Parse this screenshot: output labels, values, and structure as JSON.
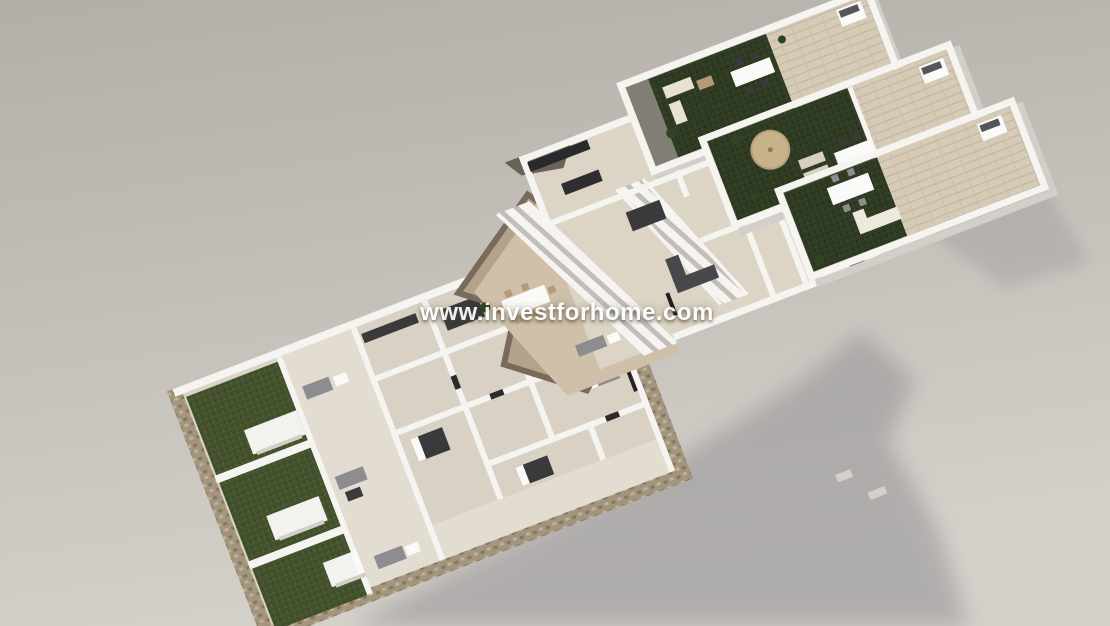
{
  "scene": {
    "description": "Aerial 3D render of an apartment development shown as three exploded levels: roof solarium terraces with lawns and barbecues (top right), upper floor with external staircases and terraces (middle), and ground-floor apartments with private gardens inside stone walls (bottom left)",
    "sections": [
      {
        "name": "roof-terrace-level"
      },
      {
        "name": "upper-floor-level"
      },
      {
        "name": "ground-floor-level"
      }
    ]
  },
  "watermark": {
    "text": "www.investforhome.com"
  },
  "palette": {
    "bg_top": "#b3aea8",
    "bg_bottom": "#d4d0ca",
    "shadow": "#8e8d91",
    "wall": "#f5f4f1",
    "wall_shade": "#d2cfc9",
    "wall_edge": "#bbb6af",
    "floor_beige": "#dbd4c6",
    "floor_light": "#e3ddd1",
    "floor_tan": "#cfc1a9",
    "deck": "#d6cbb6",
    "deck_line": "#c7bba4",
    "grass_roof": "#2f3b23",
    "grass_roof_dot": "#27321d",
    "grass_garden": "#44532e",
    "grass_garden_dot": "#394826",
    "stone": "#a3957d",
    "stone_dark": "#85775f",
    "stone_light": "#bfb197",
    "rock": "#796b5b",
    "rock_light": "#b2a38a",
    "dark_furniture": "#3a3a3c",
    "gray_furniture": "#8d8c90",
    "white_furniture": "#fafaf8",
    "wood": "#b59a77",
    "umbrella": "#c8b28c",
    "plant": "#2f4522",
    "roof_dark": "#6b6257",
    "watermark": "#ffffff"
  }
}
